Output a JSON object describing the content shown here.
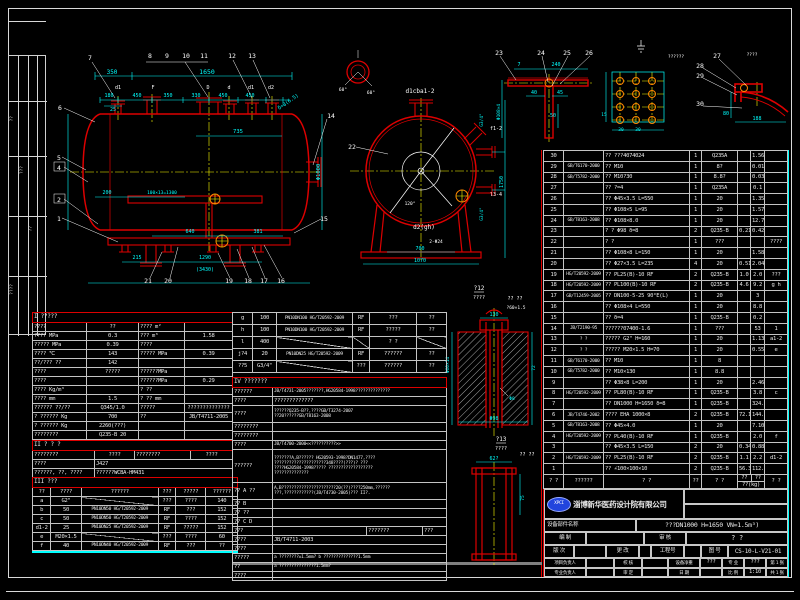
{
  "left_strip": {
    "labels": [
      "??",
      "???",
      "??",
      "????"
    ]
  },
  "dwg": {
    "front": {
      "balloons": [
        "7",
        "8",
        "9",
        "10",
        "11",
        "12",
        "13",
        "14",
        "6",
        "5",
        "4",
        "2",
        "1",
        "21",
        "20",
        "19",
        "18",
        "17",
        "16",
        "15"
      ],
      "letters": [
        "d1",
        "F",
        "D",
        "d",
        "d1",
        "d2"
      ],
      "dims": [
        "350",
        "1650",
        "180",
        "450",
        "350",
        "330",
        "450",
        "450",
        "25",
        "735",
        "Φ1000",
        "δ=8(6.5)",
        "200",
        "100×13=1300",
        "640",
        "381",
        "215",
        "1290",
        "(3430)"
      ]
    },
    "end": {
      "balloon": "22",
      "top_label": "d1cba1-2",
      "bottom_label": "d2(gh)",
      "dims": [
        "700",
        "2-Φ24",
        "1070",
        "1750",
        "G3/4\"",
        "f1-2",
        "l3-4",
        "G3/4\"",
        "120°",
        "60°",
        "60°"
      ]
    },
    "det_bracket": {
      "balloons": [
        "23",
        "24",
        "25",
        "26"
      ],
      "dims": [
        "7",
        "240",
        "40",
        "45",
        "50",
        "Φ108×4"
      ]
    },
    "det_plate": {
      "note": "??????",
      "dims": [
        "30",
        "30",
        "15"
      ]
    },
    "det_head": {
      "note": "????",
      "balloons": [
        "27",
        "28",
        "29",
        "30"
      ],
      "dims": [
        "80",
        "188"
      ]
    },
    "det12": {
      "label": "?12",
      "scale": "????",
      "note": "?? ??",
      "note2": "?60×1.5",
      "dims": [
        "130",
        "Φ60×14",
        "72",
        "Φ8",
        "Φ98"
      ]
    },
    "det13": {
      "label": "?13",
      "scale": "????",
      "note": "?? ??",
      "dims": [
        "62?",
        "75"
      ]
    }
  },
  "bom": {
    "header": {
      "no": "? ?",
      "std": "??????",
      "name": "? ?",
      "qty": "??",
      "mat": "? ?",
      "uw": "??",
      "tw": "??",
      "wt": "??(kg)",
      "rm": "? ?"
    },
    "rows": [
      {
        "no": "30",
        "std": "",
        "name": "?? ???4074024",
        "qty": "1",
        "mat": "Q235A",
        "uw": "",
        "tw": "1.56",
        "rm": ""
      },
      {
        "no": "29",
        "std": "GB/T6170-2000",
        "name": "?? M10",
        "qty": "1",
        "mat": "8?",
        "uw": "",
        "tw": "0.01",
        "rm": ""
      },
      {
        "no": "28",
        "std": "GB/T5782-2000",
        "name": "?? M10?30",
        "qty": "1",
        "mat": "8.8?",
        "uw": "",
        "tw": "0.03",
        "rm": ""
      },
      {
        "no": "27",
        "std": "",
        "name": "?? ?=4",
        "qty": "1",
        "mat": "Q235A",
        "uw": "",
        "tw": "0.1",
        "rm": ""
      },
      {
        "no": "26",
        "std": "",
        "name": "?? Φ45×3.5  L=550",
        "qty": "1",
        "mat": "20",
        "uw": "",
        "tw": "1.35",
        "rm": ""
      },
      {
        "no": "25",
        "std": "",
        "name": "?? Φ108×5  L=95",
        "qty": "1",
        "mat": "20",
        "uw": "",
        "tw": "1.57",
        "rm": ""
      },
      {
        "no": "24",
        "std": "GB/T8163-2008",
        "name": "?? Φ108×8.0",
        "qty": "1",
        "mat": "20",
        "uw": "",
        "tw": "12.7",
        "rm": ""
      },
      {
        "no": "23",
        "std": "",
        "name": "? ? Φ98 δ=8",
        "qty": "2",
        "mat": "Q235-B",
        "uw": "0.21",
        "tw": "0.42",
        "rm": ""
      },
      {
        "no": "22",
        "std": "",
        "name": "? ?",
        "qty": "1",
        "mat": "???",
        "uw": "",
        "tw": "",
        "rm": "????"
      },
      {
        "no": "21",
        "std": "",
        "name": "?? Φ108×8  L=150",
        "qty": "1",
        "mat": "20",
        "uw": "",
        "tw": "1.58",
        "rm": ""
      },
      {
        "no": "20",
        "std": "",
        "name": "?? Φ27×3.5  L=235",
        "qty": "4",
        "mat": "20",
        "uw": "0.51",
        "tw": "2.04",
        "rm": ""
      },
      {
        "no": "19",
        "std": "HG/T20592-2009",
        "name": "?? PL25(B)-10 RF",
        "qty": "2",
        "mat": "Q235-B",
        "uw": "1.0",
        "tw": "2.0",
        "rm": "???"
      },
      {
        "no": "18",
        "std": "HG/T20592-2009",
        "name": "?? PL100(B)-10 RF",
        "qty": "2",
        "mat": "Q235-B",
        "uw": "4.6",
        "tw": "9.2",
        "rm": "g h"
      },
      {
        "no": "17",
        "std": "GB/T12459-2005",
        "name": "?? DN100-5-25 90°E(L)",
        "qty": "1",
        "mat": "20",
        "uw": "",
        "tw": "3",
        "rm": ""
      },
      {
        "no": "16",
        "std": "",
        "name": "?? Φ108×4  L=550",
        "qty": "1",
        "mat": "20",
        "uw": "",
        "tw": "8.8",
        "rm": ""
      },
      {
        "no": "15",
        "std": "",
        "name": "?? δ=4",
        "qty": "1",
        "mat": "Q235-B",
        "uw": "",
        "tw": "0.2",
        "rm": ""
      },
      {
        "no": "14",
        "std": "JB/T2190-95",
        "name": "??????07400-1.6",
        "qty": "1",
        "mat": "???",
        "uw": "",
        "tw": "53",
        "rm": "1"
      },
      {
        "no": "13",
        "std": "? ?",
        "name": "????? G2\" H=160",
        "qty": "1",
        "mat": "20",
        "uw": "",
        "tw": "1.13",
        "rm": "a1-2"
      },
      {
        "no": "12",
        "std": "? ?",
        "name": "????? M20×1.5 H=70",
        "qty": "1",
        "mat": "20",
        "uw": "",
        "tw": "0.55",
        "rm": "e"
      },
      {
        "no": "11",
        "std": "GB/T6170-2000",
        "name": "?? M10",
        "qty": "1",
        "mat": "8",
        "uw": "",
        "tw": "",
        "rm": ""
      },
      {
        "no": "10",
        "std": "GB/T5782-2000",
        "name": "?? M10×130",
        "qty": "1",
        "mat": "8.8",
        "uw": "",
        "tw": "",
        "rm": ""
      },
      {
        "no": "9",
        "std": "",
        "name": "?? Φ38×8  L=200",
        "qty": "1",
        "mat": "20",
        "uw": "",
        "tw": "2.46",
        "rm": ""
      },
      {
        "no": "8",
        "std": "HG/T20592-2009",
        "name": "?? PL80(B)-10 RF",
        "qty": "1",
        "mat": "Q235-B",
        "uw": "",
        "tw": "3.8",
        "rm": "c"
      },
      {
        "no": "7",
        "std": "",
        "name": "?? DN1000 H=1650 δ=8",
        "qty": "1",
        "mat": "Q235-B",
        "uw": "",
        "tw": "324.3",
        "rm": ""
      },
      {
        "no": "6",
        "std": "JB/T4746-2002",
        "name": "???? EHA 1000×8",
        "qty": "2",
        "mat": "Q235-B",
        "uw": "72.1",
        "tw": "144.2",
        "rm": ""
      },
      {
        "no": "5",
        "std": "GB/T8163-2008",
        "name": "?? Φ45×4.0",
        "qty": "1",
        "mat": "20",
        "uw": "",
        "tw": "7.10",
        "rm": ""
      },
      {
        "no": "4",
        "std": "HG/T20592-2009",
        "name": "?? PL40(B)-10 RF",
        "qty": "1",
        "mat": "Q235-B",
        "uw": "",
        "tw": "2.0",
        "rm": "f"
      },
      {
        "no": "3",
        "std": "",
        "name": "?? Φ45×3.5  L=150",
        "qty": "2",
        "mat": "20",
        "uw": "0.34",
        "tw": "0.88",
        "rm": ""
      },
      {
        "no": "2",
        "std": "HG/T20592-2009",
        "name": "?? PL25(B)-10 RF",
        "qty": "2",
        "mat": "Q235-B",
        "uw": "1.1",
        "tw": "2.2",
        "rm": "d1-2"
      },
      {
        "no": "1",
        "std": "",
        "name": "?? ∠100×100×10",
        "qty": "2",
        "mat": "Q235-B",
        "uw": "56.3",
        "tw": "112.6",
        "rm": ""
      }
    ]
  },
  "spec": {
    "title": "I ?????",
    "rows": [
      {
        "a": "????",
        "b": "??",
        "c": "???? m²",
        "d": ""
      },
      {
        "a": "???? MPa",
        "b": "0.3",
        "c": "??? m³",
        "d": "1.58"
      },
      {
        "a": "????? MPa",
        "b": "0.39",
        "c": "????",
        "d": ""
      },
      {
        "a": "???? ℃",
        "b": "143",
        "c": "????? MPa",
        "d": "0.39"
      },
      {
        "a": "??/??? ??",
        "b": "142",
        "c": "",
        "d": ""
      },
      {
        "a": "????",
        "b": "?????",
        "c": "??????MPa",
        "d": ""
      },
      {
        "a": "????",
        "b": "",
        "c": "??????MPa",
        "d": "0.29"
      },
      {
        "a": "???? Kg/m³",
        "b": "",
        "c": "? ??",
        "d": ""
      },
      {
        "a": "???? mm",
        "b": "1.5",
        "c": "? ?? mm",
        "d": ""
      },
      {
        "a": "?????? ??/??",
        "b": "Q345/1.0",
        "c": "?????",
        "d": "??????????????"
      },
      {
        "a": "? ?????? Kg",
        "b": "700",
        "c": "??",
        "d": "JB/T4711-2005"
      },
      {
        "a": "? ?????? Kg",
        "b": "2260(???)",
        "c": "",
        "d": ""
      },
      {
        "a": "????????",
        "b": "Q235-B  20",
        "c": "",
        "d": ""
      }
    ]
  },
  "sec2": {
    "title": "II ? ? ?",
    "r1": {
      "a": "????????",
      "b": "????",
      "c": "????????",
      "d": "????"
    },
    "r2": {
      "a": "????",
      "b": "J427"
    },
    "r3": {
      "a": "??????, ??, ????",
      "b": "??????WCBA-HM431"
    }
  },
  "noz": {
    "title": "III ???",
    "headers": [
      "??",
      "????",
      "??????",
      "???",
      "?????",
      "??????"
    ],
    "rows": [
      {
        "n": "a",
        "s": "G2\"",
        "f": "",
        "sl": "???",
        "u": "????",
        "h": "140"
      },
      {
        "n": "b",
        "s": "50",
        "f": "PN10DN50 HG/T20592-2009",
        "sl": "RF",
        "u": "???",
        "h": "152"
      },
      {
        "n": "c",
        "s": "50",
        "f": "PN10DN50 HG/T20592-2009",
        "sl": "RF",
        "u": "????",
        "h": "152"
      },
      {
        "n": "d1-2",
        "s": "25",
        "f": "PN10DN25 HG/T20592-2009",
        "sl": "RF",
        "u": "?????",
        "h": "152"
      },
      {
        "n": "e",
        "s": "M20×1.5",
        "f": "",
        "sl": "???",
        "u": "????",
        "h": "60"
      },
      {
        "n": "f",
        "s": "40",
        "f": "PN10DN40 HG/T20592-2009",
        "sl": "RF",
        "u": "???",
        "h": "??"
      }
    ]
  },
  "noz2": {
    "rows": [
      {
        "n": "g",
        "s": "100",
        "f": "PN10DN100 HG/T20592-2009",
        "sl": "RF",
        "u": "???",
        "h": "??"
      },
      {
        "n": "h",
        "s": "100",
        "f": "PN10DN100 HG/T20592-2009",
        "sl": "RF",
        "u": "?????",
        "h": "??"
      },
      {
        "n": "l",
        "s": "400",
        "f": "",
        "sl": "",
        "u": "? ?",
        "h": ""
      },
      {
        "n": "j?4",
        "s": "20",
        "f": "PN10DN25 HG/T20592-2009",
        "sl": "RF",
        "u": "??????",
        "h": "??"
      },
      {
        "n": "??5",
        "s": "G3/4\"",
        "f": "",
        "sl": "???",
        "u": "??????",
        "h": "??"
      }
    ]
  },
  "req": {
    "title": "IV ???????",
    "r1l": "??????",
    "r1t": "JB/T4731-2005???????,HG20584-1998??????????????",
    "r2l": "????",
    "r2t": "?????????????",
    "r3l": "????",
    "r3t1": "??????Q235-B??,????GB/T3274-2007",
    "r3t2": "??20??????GB/T8163-2008",
    "r4l": "????????",
    "r5l": "????????",
    "r6l": "????",
    "r6t": "JB/T4700-2000<<??????????>>",
    "r7l": "??????",
    "r7a": "???????A,B?????? HG20593-1998?DN1477,????",
    "r7b": "?????????????????????348????(???)?  ???",
    "r7c": "????HG20584-1998????? ??????????????????",
    "r7d": "??????????????",
    "r8l": "?? A ??",
    "r8a": "A,B??????????????????????20(??)????250mm,??????",
    "r8b": "???,????????????(JB/T4730-2005)??? II?.",
    "r9l": "?? B",
    "r10l": "?? ??",
    "r11l": "?? C D",
    "r12l": "???",
    "r12b": "???????",
    "r12c": "???",
    "r13l": "????",
    "r13t": "JB/T4711-2003",
    "r14l": "????",
    "r15l": "?????",
    "r15t": "a ????????±1.5mm? b ??????????????1.5mm",
    "r16l": "??",
    "r16t": "a ???????????????1.5mm?",
    "r17l": "????"
  },
  "title_block": {
    "logo": "XPCI",
    "company": "淄博新华医药设计院有限公司",
    "name_label": "设备部件名称",
    "title": "???DN1000 H=1650 VN=1.5m³)",
    "r2": {
      "l1": "编 制",
      "l2": "审 核",
      "big": "? ?"
    },
    "r3": {
      "l1": "版 次",
      "l2": "更 改",
      "l3": "工程号",
      "l4": "图 号",
      "no": "CS-10-L-V21-01"
    },
    "r4": {
      "l1": "项目负责人",
      "l2": "校 核",
      "l3": "设备净重",
      "v3": "???",
      "l4": "专 业",
      "v4": "???",
      "sheet": "第 1 张"
    },
    "r5": {
      "l1": "专业负责人",
      "l2": "审 定",
      "l3": "日 期",
      "v3": "",
      "l4": "比 例",
      "v4": "1:10",
      "sheet": "共 1 张"
    }
  },
  "colors": {
    "entity_red": "#dd0000",
    "dim_cyan": "#00ffff",
    "center_yellow": "#ffff00",
    "text_white": "#e8e8e8",
    "logo_blue": "#2244dd"
  }
}
